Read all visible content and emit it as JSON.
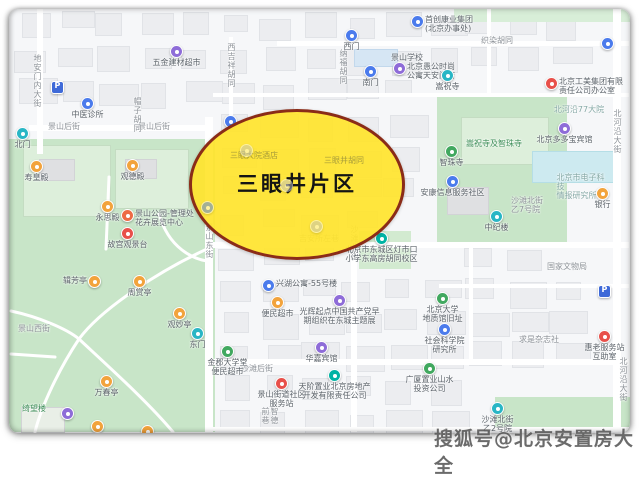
{
  "watermark": {
    "text": "搜狐号@北京安置房大全"
  },
  "highlight": {
    "label": "三眼井片区",
    "fill": "#ffe42e",
    "border": "#8a2c18"
  },
  "map": {
    "street_labels": [
      {
        "t": "地安门内大街",
        "x": 24,
        "y": 45,
        "v": true,
        "cls": "street"
      },
      {
        "t": "景山后街",
        "x": 55,
        "y": 113,
        "cls": "street"
      },
      {
        "t": "景山后街",
        "x": 145,
        "y": 113,
        "cls": "street"
      },
      {
        "t": "帽子胡同",
        "x": 124,
        "y": 88,
        "v": true,
        "cls": "street"
      },
      {
        "t": "西吉祥胡同",
        "x": 218,
        "y": 34,
        "v": true,
        "cls": "street"
      },
      {
        "t": "纳福胡同",
        "x": 330,
        "y": 40,
        "v": true,
        "cls": "street"
      },
      {
        "t": "织染胡同",
        "x": 488,
        "y": 27,
        "cls": "street"
      },
      {
        "t": "北河沿大街",
        "x": 604,
        "y": 100,
        "v": true,
        "cls": "street"
      },
      {
        "t": "北河沿大街",
        "x": 610,
        "y": 348,
        "v": true,
        "cls": "street"
      },
      {
        "t": "景山东街",
        "x": 196,
        "y": 214,
        "v": true,
        "cls": "street"
      },
      {
        "t": "沙滩北街",
        "x": 341,
        "y": 216,
        "v": true,
        "cls": "street"
      },
      {
        "t": "沙滩后街",
        "x": 248,
        "y": 355,
        "cls": "street"
      },
      {
        "t": "智德前巷",
        "x": 252,
        "y": 398,
        "v": true,
        "cls": "street"
      },
      {
        "t": "吉安所左巷",
        "x": 310,
        "y": 225,
        "cls": "street"
      },
      {
        "t": "景山西街",
        "x": 25,
        "y": 315,
        "cls": "street"
      },
      {
        "t": "景山学校",
        "x": 398,
        "y": 44
      },
      {
        "t": "绮望楼",
        "x": 25,
        "y": 395,
        "cls": "green-text"
      },
      {
        "t": "三眼井胡同",
        "x": 335,
        "y": 147,
        "cls": "in-ellipse"
      },
      {
        "t": "三眼大院酒店",
        "x": 245,
        "y": 142,
        "cls": "in-ellipse"
      },
      {
        "t": "沙滩北街\n乙7号院",
        "x": 518,
        "y": 187,
        "cls": "street"
      },
      {
        "t": "国家文物局",
        "x": 558,
        "y": 253,
        "cls": "street"
      },
      {
        "t": "求是杂志社",
        "x": 530,
        "y": 326,
        "cls": "street"
      },
      {
        "t": "北河沿77大院",
        "x": 570,
        "y": 96,
        "cls": "teal-text"
      },
      {
        "t": "嵩祝寺及智珠寺",
        "x": 485,
        "y": 130,
        "cls": "green-text"
      },
      {
        "t": "北京市电子科技\n情报研究所",
        "x": 572,
        "y": 164,
        "cls": "teal-text"
      }
    ],
    "pois": [
      {
        "x": 167,
        "y": 42,
        "c": "purple",
        "t": "五金建材超市"
      },
      {
        "x": 342,
        "y": 26,
        "c": "blue",
        "t": "西门"
      },
      {
        "x": 361,
        "y": 62,
        "c": "blue",
        "t": "南门"
      },
      {
        "x": 390,
        "y": 59,
        "c": "purple",
        "t": "北京愚公时尚\n公寓天安门店",
        "side": "right"
      },
      {
        "x": 408,
        "y": 12,
        "c": "blue",
        "t": "首创康业集团\n(北京办事处)",
        "side": "right"
      },
      {
        "x": 598,
        "y": 34,
        "c": "blue"
      },
      {
        "x": 438,
        "y": 66,
        "c": "cyan",
        "t": "嵩祝寺"
      },
      {
        "x": 542,
        "y": 74,
        "c": "red",
        "t": "北京工美集团有限\n责任公司办公室",
        "side": "right"
      },
      {
        "x": 555,
        "y": 119,
        "c": "purple",
        "t": "北京多多宝宾馆"
      },
      {
        "x": 442,
        "y": 142,
        "c": "green",
        "t": "智珠寺"
      },
      {
        "x": 443,
        "y": 172,
        "c": "blue",
        "t": "安康信息服务社区"
      },
      {
        "x": 487,
        "y": 207,
        "c": "cyan",
        "t": "中纪楼"
      },
      {
        "x": 593,
        "y": 184,
        "c": "orange",
        "t": "银行"
      },
      {
        "x": 595,
        "y": 282,
        "c": "parking"
      },
      {
        "x": 48,
        "y": 78,
        "c": "parking"
      },
      {
        "x": 78,
        "y": 94,
        "c": "blue",
        "t": "中医诊所"
      },
      {
        "x": 433,
        "y": 289,
        "c": "green",
        "t": "北京大学\n地质馆旧址"
      },
      {
        "x": 435,
        "y": 320,
        "c": "blue",
        "t": "社会科学院\n研究所"
      },
      {
        "x": 595,
        "y": 327,
        "c": "red",
        "t": "惠老服务站\n互助室"
      },
      {
        "x": 488,
        "y": 399,
        "c": "cyan",
        "t": "沙滩北街\n乙2号院"
      },
      {
        "x": 372,
        "y": 229,
        "c": "teal",
        "t": "北京市东城区灯市口\n小学东高房胡同校区"
      },
      {
        "x": 259,
        "y": 276,
        "c": "blue",
        "t": "兴湖公寓-55号楼",
        "side": "right"
      },
      {
        "x": 268,
        "y": 293,
        "c": "orange",
        "t": "便民超市"
      },
      {
        "x": 330,
        "y": 291,
        "c": "purple",
        "t": "光辉起点中国共产党早\n期组织在东城主题展"
      },
      {
        "x": 312,
        "y": 338,
        "c": "purple",
        "t": "华嘉宾馆"
      },
      {
        "x": 218,
        "y": 342,
        "c": "green",
        "t": "金郡大学堂\n便民超市"
      },
      {
        "x": 272,
        "y": 374,
        "c": "red",
        "t": "景山街道社区\n服务站"
      },
      {
        "x": 325,
        "y": 366,
        "c": "teal",
        "t": "天阶置业北京房地产\n开发有限责任公司"
      },
      {
        "x": 420,
        "y": 359,
        "c": "green",
        "t": "广厦置业山水\n投资公司"
      },
      {
        "x": 13,
        "y": 124,
        "c": "cyan",
        "t": "北门"
      },
      {
        "x": 188,
        "y": 324,
        "c": "cyan",
        "t": "东门"
      },
      {
        "x": 27,
        "y": 157,
        "c": "orange",
        "t": "寿皇殿"
      },
      {
        "x": 123,
        "y": 156,
        "c": "orange",
        "t": "观德殿"
      },
      {
        "x": 98,
        "y": 197,
        "c": "orange",
        "t": "永思殿"
      },
      {
        "x": 118,
        "y": 206,
        "c": "redorange",
        "t": "景山公园-管理处\n花卉展览中心",
        "side": "right"
      },
      {
        "x": 118,
        "y": 224,
        "c": "red",
        "t": "故宫观景台"
      },
      {
        "x": 85,
        "y": 272,
        "c": "orange",
        "t": "辑芳亭",
        "side": "left"
      },
      {
        "x": 130,
        "y": 272,
        "c": "orange",
        "t": "周赏亭"
      },
      {
        "x": 170,
        "y": 304,
        "c": "orange",
        "t": "观妙亭"
      },
      {
        "x": 97,
        "y": 372,
        "c": "orange",
        "t": "万春亭"
      },
      {
        "x": 58,
        "y": 404,
        "c": "purple"
      },
      {
        "x": 88,
        "y": 417,
        "c": "orange"
      },
      {
        "x": 138,
        "y": 422,
        "c": "orange"
      },
      {
        "x": 221,
        "y": 112,
        "c": "blue"
      },
      {
        "x": 198,
        "y": 198,
        "c": "blue",
        "faint": true
      },
      {
        "x": 237,
        "y": 141,
        "c": "gray",
        "faint": true
      },
      {
        "x": 277,
        "y": 176,
        "c": "gray",
        "faint": true
      },
      {
        "x": 307,
        "y": 217,
        "c": "gray",
        "faint": true
      }
    ],
    "poi_colors": {
      "blue": "#4b7bec",
      "cyan": "#29b6c5",
      "purple": "#8e6cd8",
      "teal": "#00b3a4",
      "green": "#41a85f",
      "orange": "#f2a33c",
      "red": "#e8504a",
      "redorange": "#ed6a45",
      "gray": "#c0c3c9",
      "parking": "#3f6ad8"
    }
  }
}
